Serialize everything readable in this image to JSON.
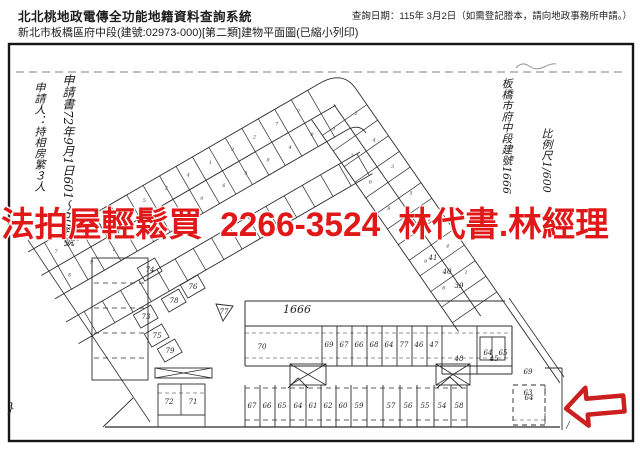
{
  "header": {
    "system_title": "北北桃地政電傳全功能地籍資料查詢系統",
    "doc_subtitle": "新北市板橋區府中段(建號:02973-000)[第二類]建物平面圖(已縮小列印)",
    "query_date_line": "查詢日期：115年 3月2日（如需登記謄本，請向地政事務所申請。）"
  },
  "overlay_ad": {
    "text": "法拍屋輕鬆買 2266-3524 林代書.林經理",
    "phone": "2266-3524",
    "color": "#e01818"
  },
  "plan": {
    "colors": {
      "ink": "#2b2b2b",
      "arrow_red": "#cc2020"
    },
    "handwritten_notes": [
      {
        "id": "left-note-applicant",
        "text": "申請人：持相房繁３人"
      },
      {
        "id": "left-note-docno",
        "text": "申請書72年9月1日601〜604號"
      },
      {
        "id": "right-note-section",
        "text": "板橋市府中段建號1666"
      },
      {
        "id": "right-note-scale",
        "text": "比例尺1/600"
      }
    ],
    "parcel_label": "1666",
    "row1_units": [
      "70",
      "69",
      "67",
      "66",
      "68",
      "64",
      "77",
      "46",
      "47",
      "48",
      "45"
    ],
    "row2_units": [
      "67",
      "66",
      "65",
      "64",
      "61",
      "62",
      "60",
      "59"
    ],
    "row2b_units": [
      "57",
      "56",
      "55",
      "54",
      "58"
    ],
    "row2c_unit": "64",
    "left_units": [
      "72",
      "71"
    ],
    "scatter_units": [
      {
        "t": "74",
        "x": 150,
        "y": 270
      },
      {
        "t": "76",
        "x": 193,
        "y": 287
      },
      {
        "t": "78",
        "x": 174,
        "y": 301
      },
      {
        "t": "73",
        "x": 146,
        "y": 317
      },
      {
        "t": "75",
        "x": 157,
        "y": 336
      },
      {
        "t": "79",
        "x": 170,
        "y": 351
      },
      {
        "t": "77",
        "x": 224,
        "y": 312
      },
      {
        "t": "41",
        "x": 433,
        "y": 258
      },
      {
        "t": "40",
        "x": 447,
        "y": 272
      },
      {
        "t": "39",
        "x": 459,
        "y": 286
      },
      {
        "t": "64",
        "x": 488,
        "y": 353
      },
      {
        "t": "65",
        "x": 503,
        "y": 353
      },
      {
        "t": "69",
        "x": 528,
        "y": 372
      },
      {
        "t": "63",
        "x": 528,
        "y": 393
      }
    ],
    "band_digits": [
      "7",
      "8",
      "2",
      "9",
      "4",
      "1",
      "3",
      "6",
      "5",
      "8",
      "2",
      "7",
      "4",
      "9",
      "1",
      "6",
      "3",
      "5",
      "2",
      "8",
      "7",
      "4"
    ],
    "marks": {
      "brace": "}",
      "slash": "/"
    }
  }
}
